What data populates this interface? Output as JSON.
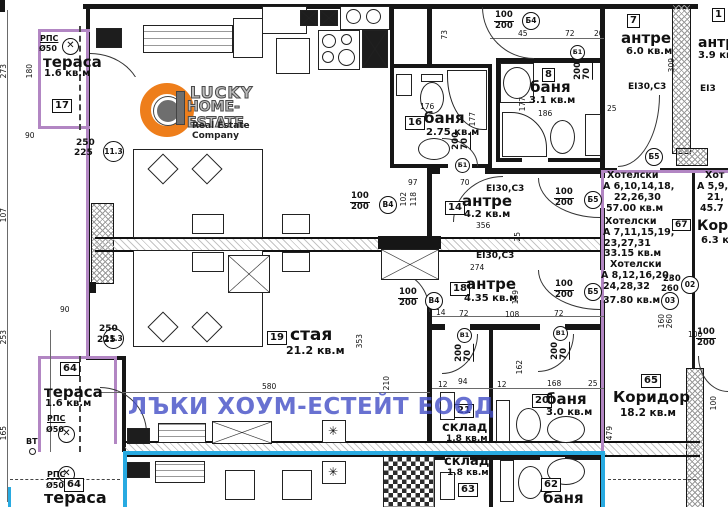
{
  "watermark": {
    "text": "ЛЪКИ ХОУМ-ЕСТЕЙТ ЕООД",
    "color": "#4752c8"
  },
  "logo": {
    "line1": "LUCKY",
    "line2": "HOME-ESTATE",
    "tagline": "Real Estate Company",
    "orange": "#ee7e1b"
  },
  "colors": {
    "boundary_purple": "#b286c3",
    "utility_cyan": "#28aae1",
    "wall": "#161616"
  },
  "rooms": {
    "t17": {
      "num": "17",
      "name": "тераса",
      "area": "1.6 кв.м"
    },
    "b16": {
      "num": "16",
      "name": "баня",
      "area": "2.75 кв.м"
    },
    "b8": {
      "num": "8",
      "name": "баня",
      "area": "3.1 кв.м"
    },
    "h7": {
      "num": "7",
      "name": "антре",
      "area": "6.0 кв.м"
    },
    "h14": {
      "num": "14",
      "name": "антре",
      "area": "4.2 кв.м"
    },
    "h18": {
      "num": "18",
      "name": "антре",
      "area": "4.35 кв.м"
    },
    "r19": {
      "num": "19",
      "name": "стая",
      "area": "21.2 кв.м"
    },
    "s21": {
      "num": "21",
      "name": "склад",
      "area": "1.8 кв.м"
    },
    "b20": {
      "num": "20",
      "name": "баня",
      "area": "3.0 кв.м"
    },
    "t64": {
      "num": "64",
      "name": "тераса",
      "area": "1.6 кв.м"
    },
    "c65": {
      "num": "65",
      "name": "Коридор",
      "area": "18.2 кв.м"
    },
    "s63": {
      "num": "63",
      "name": "склад",
      "area": "1.8 кв.м"
    },
    "b62": {
      "num": "62",
      "name": "баня"
    },
    "t64b": {
      "num": "64",
      "name": "тераса"
    },
    "r1": {
      "num": "1",
      "name": "антре",
      "area": "3.9 кв.м"
    }
  },
  "hotel": {
    "g1": [
      "Хотелски",
      "А 6,10,14,18,",
      "22,26,30",
      "57.00 кв.м"
    ],
    "g2": [
      "Хотелски",
      "А 7,11,15,19,",
      "23,27,31",
      "33.15 кв.м"
    ],
    "g3": [
      "Хотелски",
      "А 8,12,16,20,",
      "24,28,32",
      "37.80 кв.м"
    ],
    "right_col": [
      "Хот",
      "А 5,9,",
      "21,",
      "45.7"
    ],
    "box67": "67",
    "kor": "Кор",
    "kor_area": "6.3 к"
  },
  "fire": {
    "a": "EI30,C3",
    "b": "EI30,C3",
    "c": "EI30,C3",
    "d": "EI3"
  },
  "tags": {
    "t1": {
      "top": "100",
      "bot": "200",
      "c": "Б4"
    },
    "t2": {
      "top": "100",
      "bot": "200",
      "c": "Б5"
    },
    "t3": {
      "top": "100",
      "bot": "200",
      "c": "Б5"
    },
    "t4": {
      "top": "100",
      "bot": "200",
      "c": "В4"
    },
    "t5": {
      "top": "100",
      "bot": "200",
      "c": "В4"
    },
    "t6": {
      "top": "70",
      "bot": "200",
      "c": "Б1"
    },
    "t7": {
      "top": "70",
      "bot": "200",
      "c": "Б1"
    },
    "t8": {
      "top": "70",
      "bot": "200",
      "c": "В1"
    },
    "t9": {
      "top": "70",
      "bot": "200",
      "c": "В1"
    },
    "t10": {
      "top": "100",
      "bot": "200"
    },
    "t11": {
      "c": "Б5"
    }
  },
  "circles": {
    "c02": "02",
    "c03": "03"
  },
  "axis": {
    "a1": "11.3",
    "a2": "11.3"
  },
  "vents": {
    "rps": "РПС",
    "d50": "Ø50",
    "vt": "ВТ",
    "fan": "✕"
  },
  "furn_marks": {
    "star": "✳"
  },
  "dims": [
    "180",
    "90",
    "250",
    "225",
    "273",
    "107",
    "253",
    "165",
    "90",
    "250",
    "225",
    "97",
    "70",
    "102",
    "118",
    "356",
    "73",
    "176",
    "177",
    "45",
    "72",
    "20",
    "177",
    "186",
    "25",
    "309",
    "274",
    "14",
    "72",
    "108",
    "72",
    "159",
    "25",
    "580",
    "353",
    "210",
    "12",
    "94",
    "12",
    "168",
    "25",
    "162",
    "479",
    "100",
    "230",
    "260",
    "160",
    "260",
    "100"
  ]
}
